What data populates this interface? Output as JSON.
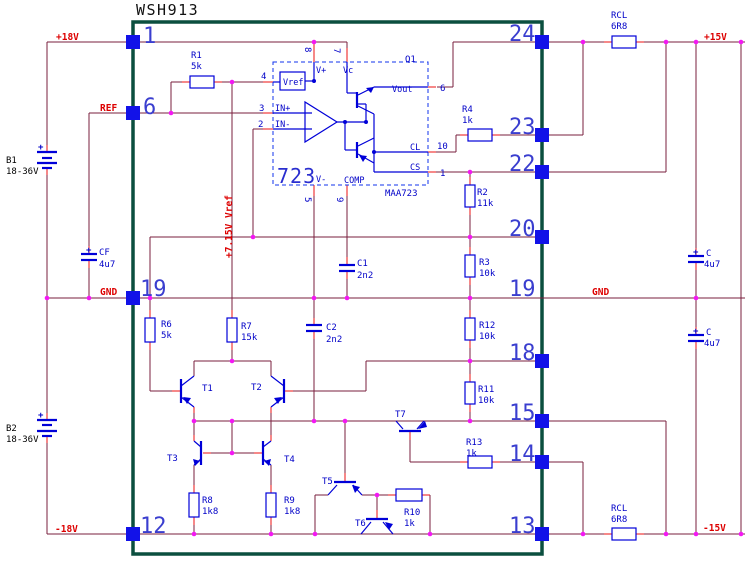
{
  "title": "WSH913",
  "module_pins": {
    "p1": "1",
    "p6": "6",
    "p19l": "19",
    "p12": "12",
    "p24": "24",
    "p23": "23",
    "p22": "22",
    "p20": "20",
    "p19r": "19",
    "p18": "18",
    "p15": "15",
    "p14": "14",
    "p13": "13"
  },
  "nets": {
    "plus18": "+18V",
    "ref": "REF",
    "gnd_left": "GND",
    "minus18": "-18V",
    "plus15": "+15V",
    "gnd_right": "GND",
    "minus15": "-15V",
    "vref_rail": "+7.15V Vref"
  },
  "ic": {
    "number": "723",
    "part": "MAA723",
    "output_transistor": "Q1",
    "ports": {
      "vref": "Vref",
      "vplus": "V+",
      "vc": "Vc",
      "vout": "Vout",
      "cl": "CL",
      "cs": "CS",
      "vminus": "V-",
      "comp": "COMP",
      "in_plus": "IN+",
      "in_minus": "IN-"
    },
    "pin_numbers": {
      "p8": "8",
      "p7": "7",
      "p4": "4",
      "p3": "3",
      "p2": "2",
      "p6": "6",
      "p10": "10",
      "p1": "1",
      "p5": "5",
      "p9": "9"
    }
  },
  "resistors": {
    "r1": {
      "name": "R1",
      "value": "5k"
    },
    "r2": {
      "name": "R2",
      "value": "11k"
    },
    "r3": {
      "name": "R3",
      "value": "10k"
    },
    "r4": {
      "name": "R4",
      "value": "1k"
    },
    "r6": {
      "name": "R6",
      "value": "5k"
    },
    "r7": {
      "name": "R7",
      "value": "15k"
    },
    "r8": {
      "name": "R8",
      "value": "1k8"
    },
    "r9": {
      "name": "R9",
      "value": "1k8"
    },
    "r10": {
      "name": "R10",
      "value": "1k"
    },
    "r11": {
      "name": "R11",
      "value": "10k"
    },
    "r12": {
      "name": "R12",
      "value": "10k"
    },
    "r13": {
      "name": "R13",
      "value": "1k"
    },
    "rcl_top": {
      "name": "RCL",
      "value": "6R8"
    },
    "rcl_bottom": {
      "name": "RCL",
      "value": "6R8"
    }
  },
  "capacitors": {
    "c1": {
      "name": "C1",
      "value": "2n2"
    },
    "c2": {
      "name": "C2",
      "value": "2n2"
    },
    "cf": {
      "name": "CF",
      "value": "4u7",
      "polarity": "+"
    },
    "c_pos": {
      "name": "C",
      "value": "4u7",
      "polarity": "+"
    },
    "c_neg": {
      "name": "C",
      "value": "4u7",
      "polarity": "+"
    }
  },
  "batteries": {
    "b1": {
      "name": "B1",
      "value": "18-36V",
      "polarity": "+"
    },
    "b2": {
      "name": "B2",
      "value": "18-36V",
      "polarity": "+"
    }
  },
  "transistors": {
    "t1": "T1",
    "t2": "T2",
    "t3": "T3",
    "t4": "T4",
    "t5": "T5",
    "t6": "T6",
    "t7": "T7"
  },
  "colors": {
    "wire": "#7a1f3e",
    "component": "#0000d8",
    "junction": "#f318f3",
    "pad": "#1212e8",
    "module_box": "#0b4f3f",
    "net_label": "#dd0000"
  }
}
